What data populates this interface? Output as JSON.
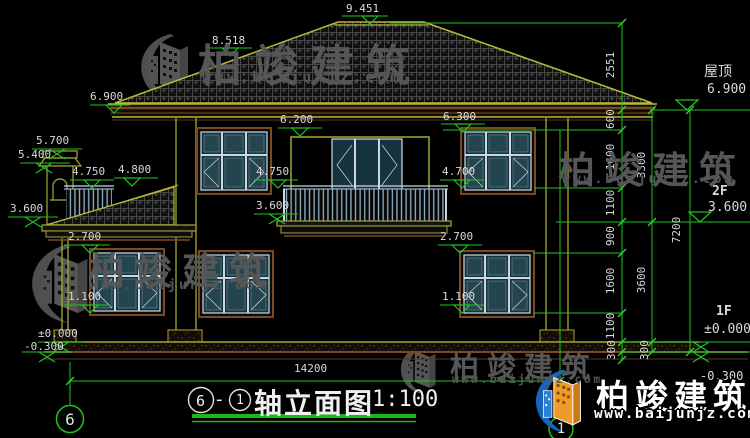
{
  "watermark": {
    "brand": "柏竣建筑",
    "url": "www.baijunjz.com"
  },
  "title": {
    "axis_from": "6",
    "separator": "-",
    "axis_to": "1",
    "text": "轴立面图",
    "scale": "1:100"
  },
  "axis_bubbles": {
    "left": "6",
    "right": "1"
  },
  "floor_labels": {
    "roof_name": "屋顶",
    "roof_elev": "6.900",
    "f2_name": "2F",
    "f2_elev": "3.600",
    "f1_name": "1F",
    "f1_elev": "±0.000",
    "f1_below": "-0.300"
  },
  "levels": {
    "ridge": "9.451",
    "roof_mid": "8.518",
    "eave": "6.900",
    "chimney_top": "5.700",
    "chimney_cap": "5.400",
    "porch_rail": "4.750",
    "porch_eave": "4.800",
    "balcony_door_top": "6.200",
    "f2_window_top": "6.300",
    "f2_sill_left": "4.750",
    "f2_sill_right": "4.700",
    "f2_floor_left": "3.600",
    "f2_floor_center": "3.600",
    "f1_window_top_left": "2.700",
    "f1_window_top_right": "2.700",
    "f1_sill_left": "1.100",
    "f1_sill_right": "1.100",
    "ground": "±0.000",
    "grade": "-0.300"
  },
  "dimensions": {
    "chain_inner": [
      "2551",
      "600",
      "1600",
      "1100",
      "900",
      "1600",
      "1100",
      "300"
    ],
    "chain_middle": [
      "3300",
      "3600",
      "300"
    ],
    "chain_outer": [
      "7200"
    ],
    "overall_width": "14200"
  }
}
